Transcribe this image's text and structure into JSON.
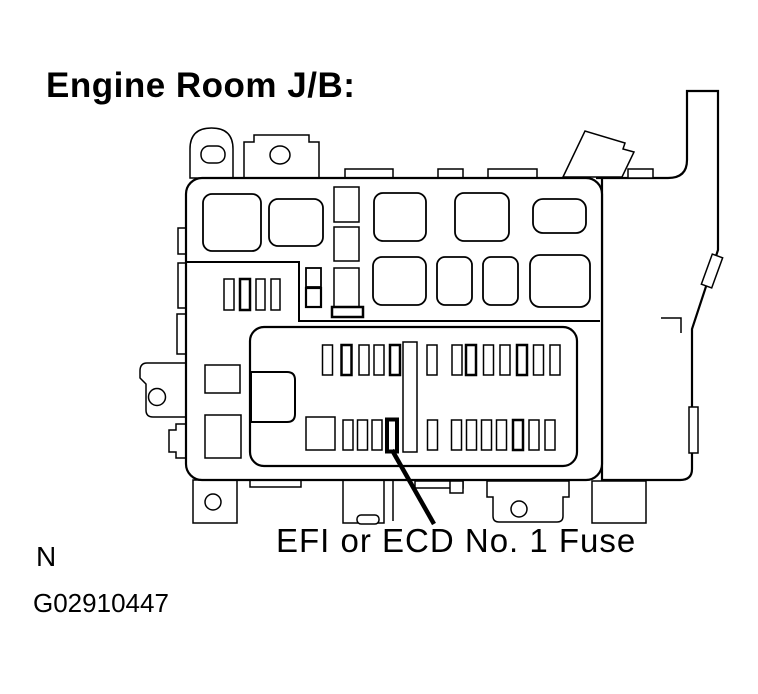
{
  "page": {
    "background_color": "#ffffff",
    "line_color": "#000000"
  },
  "texts": {
    "title": "Engine Room J/B:",
    "callout": "EFI or ECD No. 1 Fuse",
    "note": "N",
    "figure_id": "G02910447"
  },
  "diagram": {
    "name": "Engine Room Junction Block fuse box top view",
    "highlighted_component": "EFI or ECD No. 1 Fuse",
    "callout_target": "bold small fuse slot in lower row of inner fuse panel",
    "inner_fuse_panel": {
      "top_row_slot_count": 13,
      "bottom_row_slot_count": 12,
      "has_center_divider": true,
      "has_left_notch": true
    },
    "relay_block_slot_count": 9,
    "mounting_tabs": [
      "top-left dome tab",
      "top-left stepped tab",
      "left bracket with hole",
      "bottom feet with holes"
    ]
  }
}
